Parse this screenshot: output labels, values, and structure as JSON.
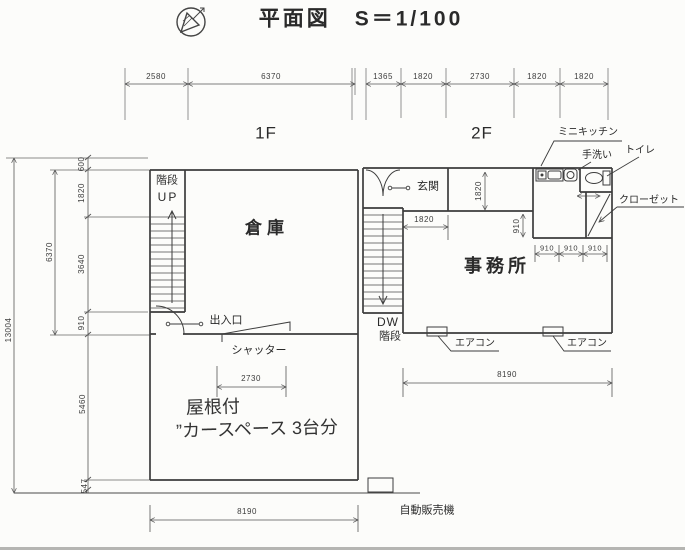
{
  "title": "平面図　S＝1/100",
  "floor_labels": {
    "f1": "1F",
    "f2": "2F"
  },
  "dims": {
    "top_1f": [
      "2580",
      "6370"
    ],
    "top_2f": [
      "1365",
      "1820",
      "2730",
      "1820",
      "1820"
    ],
    "left_outer": "13004",
    "left_span": "6370",
    "left_inner": [
      "600",
      "1820",
      "3640",
      "910",
      "5460",
      "547"
    ],
    "carport_width": "2730",
    "bottom_1f": "8190",
    "bottom_2f": "8190",
    "genkan_width": "1820",
    "office_top_height": "1820",
    "office_right": "910",
    "sanitary": [
      "910",
      "910",
      "910"
    ]
  },
  "f1": {
    "stairs": "階段",
    "up": "UP",
    "warehouse": "倉庫",
    "entrance": "出入口",
    "shutter": "シャッター",
    "note1": "屋根付",
    "note2": "”カースペース 3台分"
  },
  "f2": {
    "genkan": "玄関",
    "dw": "DW",
    "stairs": "階段",
    "office": "事務所",
    "mini_kitchen": "ミニキッチン",
    "hand_wash": "手洗い",
    "toilet": "トイレ",
    "closet": "クローゼット",
    "aircon_1": "エアコン",
    "aircon_2": "エアコン"
  },
  "site": {
    "vending": "自動販売機"
  },
  "colors": {
    "wall": "#3d3d3d",
    "dimline": "#555555",
    "text": "#2a2a2a",
    "bg": "#fcfcfa"
  }
}
